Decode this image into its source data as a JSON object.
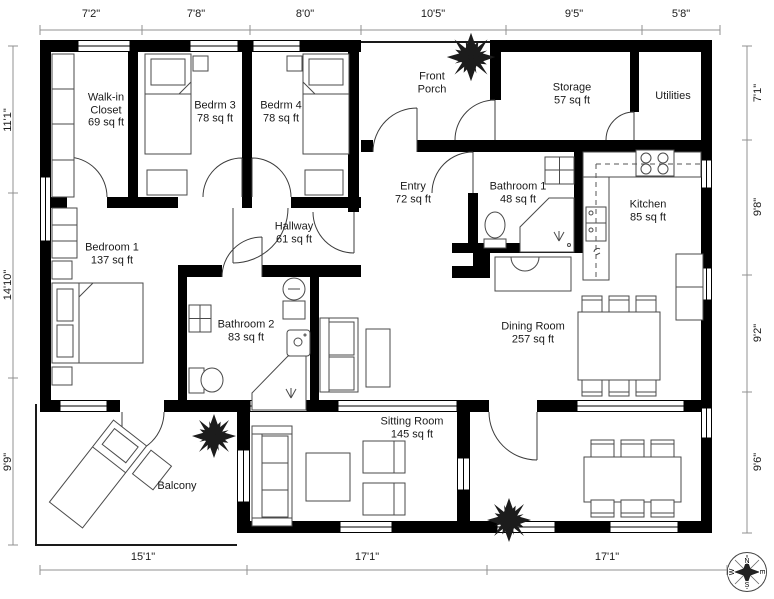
{
  "dimensions": {
    "top": [
      "7'2\"",
      "7'8\"",
      "8'0\"",
      "10'5\"",
      "9'5\"",
      "5'8\""
    ],
    "bottom": [
      "15'1\"",
      "17'1\"",
      "17'1\""
    ],
    "left": [
      "11'1\"",
      "14'10\"",
      "9'9\""
    ],
    "right": [
      "7'1\"",
      "9'8\"",
      "9'2\"",
      "9'6\""
    ]
  },
  "rooms": {
    "walk_in_closet": {
      "name": "Walk-in Closet",
      "area": "69 sq ft"
    },
    "bedrm3": {
      "name": "Bedrm 3",
      "area": "78 sq ft"
    },
    "bedrm4": {
      "name": "Bedrm 4",
      "area": "78 sq ft"
    },
    "front_porch": {
      "name": "Front Porch",
      "area": ""
    },
    "storage": {
      "name": "Storage",
      "area": "57 sq ft"
    },
    "utilities": {
      "name": "Utilities",
      "area": ""
    },
    "entry": {
      "name": "Entry",
      "area": "72 sq ft"
    },
    "bathroom1": {
      "name": "Bathroom 1",
      "area": "48 sq ft"
    },
    "kitchen": {
      "name": "Kitchen",
      "area": "85 sq ft"
    },
    "hallway": {
      "name": "Hallway",
      "area": "61 sq ft"
    },
    "bedroom1": {
      "name": "Bedroom 1",
      "area": "137 sq ft"
    },
    "bathroom2": {
      "name": "Bathroom 2",
      "area": "83 sq ft"
    },
    "dining_room": {
      "name": "Dining Room",
      "area": "257 sq ft"
    },
    "sitting_room": {
      "name": "Sitting Room",
      "area": "145 sq ft"
    },
    "balcony": {
      "name": "Balcony",
      "area": ""
    }
  },
  "compass": {
    "north": "N",
    "east": "E",
    "south": "S",
    "west": "W"
  },
  "colors": {
    "wall": "#000000",
    "dimension_line": "#909090",
    "furniture_line": "#4a4a4a",
    "plant": "#1c1c1c",
    "background": "#ffffff"
  }
}
